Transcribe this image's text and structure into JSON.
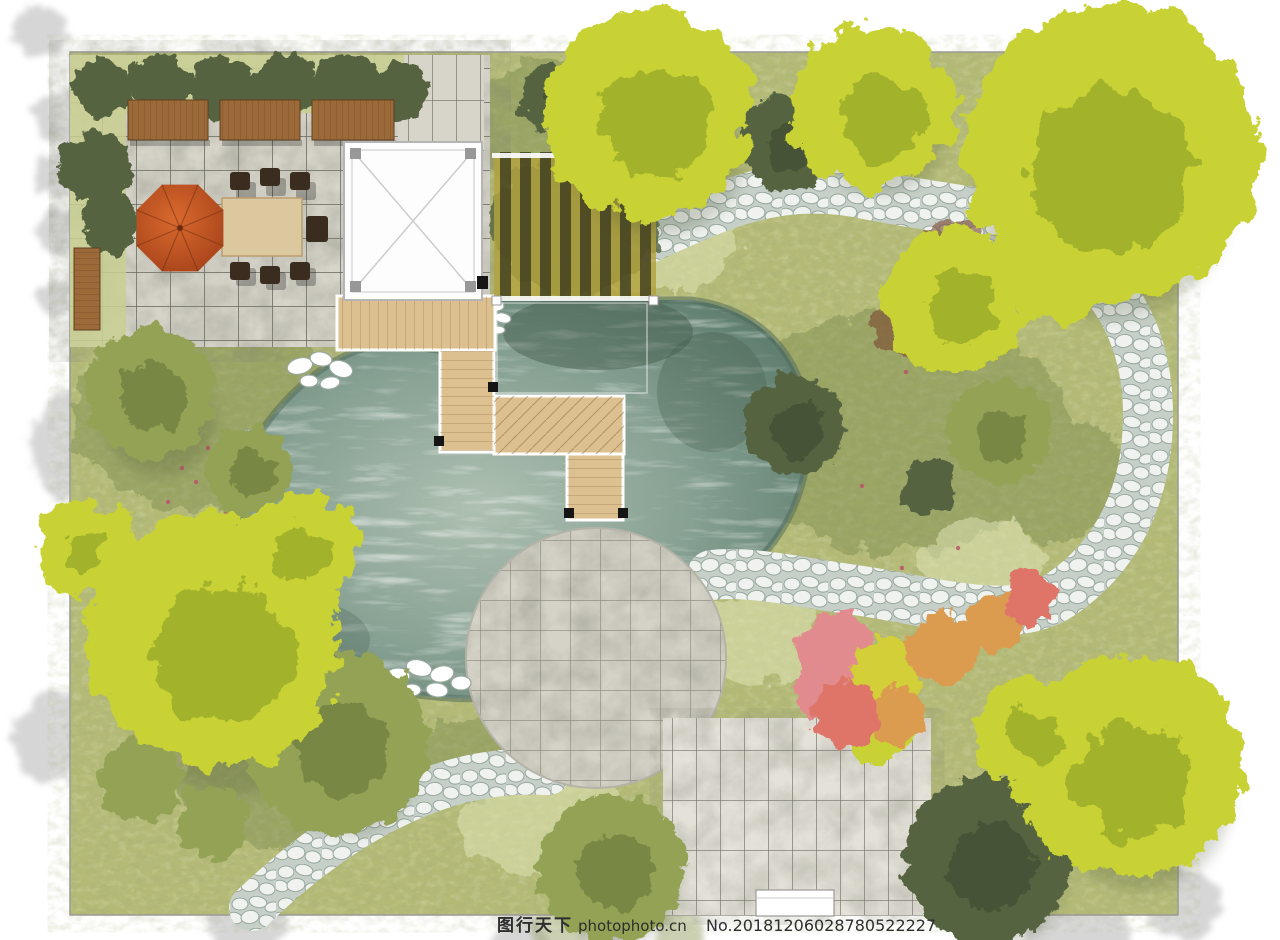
{
  "watermark": {
    "brand": "图行天下",
    "site": "photophoto.cn",
    "serial": "No.20181206028780522227"
  },
  "palette": {
    "border_line": "#9a9a94",
    "grass_base": "#b4ba76",
    "grass_light": "#e4e8bc",
    "grass_dark": "#76864c",
    "hedge_grass": "#c9cf92",
    "tile_fill": "#d7d5ca",
    "tile_line": "#4f4f44",
    "plaza_fill": "#d5d3c7",
    "plaza_line": "#6e6e5e",
    "patio_fill": "#e4e2d8",
    "patio_line": "#55544a",
    "pond_light": "#aec0b2",
    "pond_mid": "#86a092",
    "pond_deep": "#5c7c6c",
    "pond_edge": "#4c685a",
    "pebble_bg": "#c6d0c8",
    "pebble_stone": "#eff2ef",
    "stone_edge": "#97a89e",
    "stone_white": "#ffffff",
    "deck_wood": "#dcc08f",
    "deck_line": "#8a6a42",
    "bench_wood": "#9c6a38",
    "bench_line": "#6b4524",
    "table_wood": "#dbc89e",
    "chair_dark": "#3a2d20",
    "umbrella_light": "#d96a2e",
    "umbrella_dark": "#a23f18",
    "umbrella_rib": "#6e2c10",
    "pergola_fill": "#fdfdfd",
    "pergola_frame": "#b5b5b5",
    "pergola_post": "#989898",
    "canopy_gold": "#b2a23e",
    "canopy_slat": "#30301b",
    "tree_chartreuse": "#c8d235",
    "tree_chartreuse_dark": "#7f9422",
    "tree_olive": "#93a254",
    "tree_olive_dark": "#5e7035",
    "tree_darkgreen": "#556440",
    "tree_darkgreen_dark": "#35402a",
    "shrub_pink": "#e28b8e",
    "shrub_yellow": "#d2cf39",
    "shrub_orange": "#db9c50",
    "shrub_salmon": "#df7567",
    "bush_maroon": "#7c4a33",
    "flower_red": "#b85568",
    "margin_shadow": "#cccccc",
    "margin_shadow_green": "#9aa36b",
    "watermark_color": "#2e2e2e"
  }
}
